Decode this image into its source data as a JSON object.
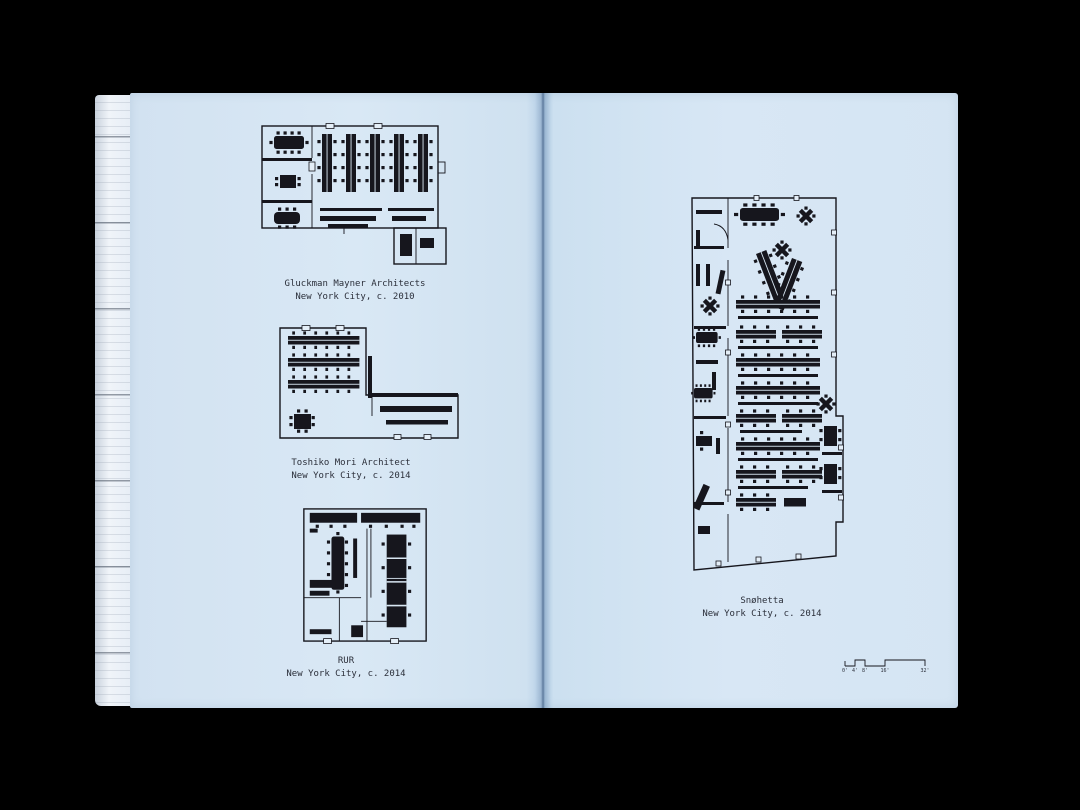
{
  "photo": {
    "subject": "open-book-spread-of-office-floor-plans",
    "background_color": "#000000",
    "page_color": "#d7e6f4",
    "ink_color": "#16161d"
  },
  "plans": [
    {
      "id": "gluckman-mayner",
      "name": "Gluckman Mayner Architects",
      "location": "New York City, c. 2010"
    },
    {
      "id": "toshiko-mori",
      "name": "Toshiko Mori Architect",
      "location": "New York City, c. 2014"
    },
    {
      "id": "rur",
      "name": "RUR",
      "location": "New York City, c. 2014"
    },
    {
      "id": "snohetta",
      "name": "Snøhetta",
      "location": "New York City, c. 2014"
    }
  ],
  "scale_bar": {
    "labels": [
      "0'",
      "4'",
      "8'",
      "16'",
      "32'"
    ]
  }
}
